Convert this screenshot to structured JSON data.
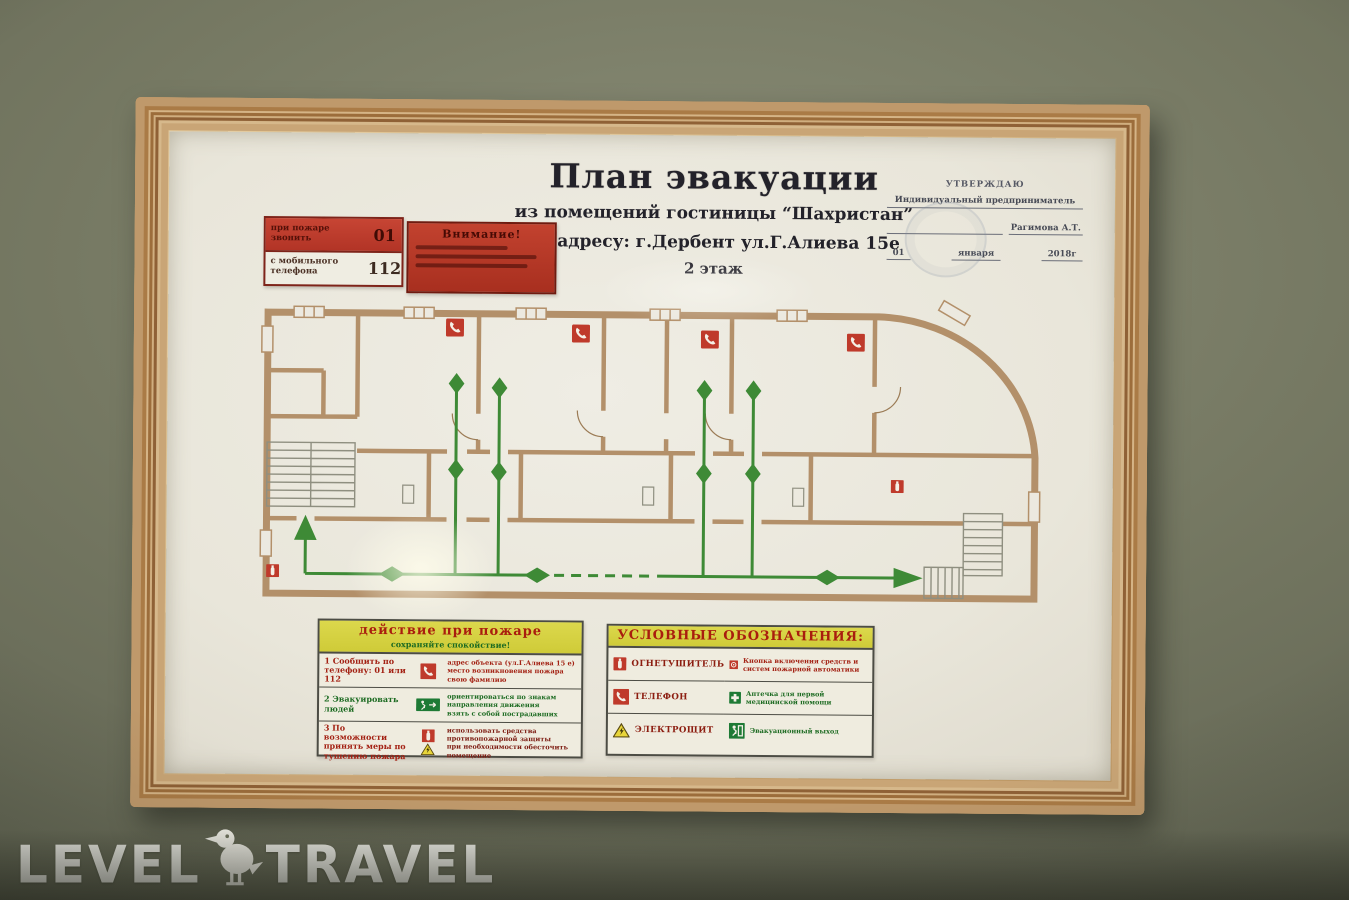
{
  "header": {
    "title": "План эвакуации",
    "subtitle": "из помещений гостиницы “Шахристан”",
    "address": "по адресу: г.Дербент ул.Г.Алиева 15е",
    "floor": "2 этаж"
  },
  "call_box": {
    "top_label": "при пожаре звонить",
    "top_number": "01",
    "bottom_label": "с мобильного телефона",
    "bottom_number": "112"
  },
  "attention_box": {
    "title": "Внимание!"
  },
  "approval": {
    "line1": "УТВЕРЖДАЮ",
    "line2": "Индивидуальный предприниматель",
    "name": "Рагимова А.Т.",
    "date_day": "01",
    "date_month": "января",
    "date_year": "2018г"
  },
  "actions_table": {
    "header": "действие при пожаре",
    "subheader": "сохраняйте спокойствие!",
    "rows": [
      {
        "label": "1 Сообщить по телефону: 01 или 112",
        "icon": "phone-icon",
        "desc": [
          "адрес объекта (ул.Г.Алиева 15 е)",
          "место возникновения пожара",
          "свою фамилию"
        ]
      },
      {
        "label": "2 Эвакуировать людей",
        "icon": "emergency-exit-icon",
        "desc": [
          "ориентироваться по знакам",
          "направления движения",
          "взять с собой пострадавших"
        ]
      },
      {
        "label": "3 По возможности принять меры по тушению пожара",
        "icon": "fire-extinguisher-icon warning-triangle-icon",
        "desc": [
          "использовать средства",
          "противопожарной защиты",
          "при необходимости обесточить помещение"
        ]
      }
    ]
  },
  "legend_table": {
    "header": "УСЛОВНЫЕ ОБОЗНАЧЕНИЯ:",
    "items": [
      {
        "icon": "fire-extinguisher-icon",
        "label": "ОГНЕТУШИТЕЛЬ"
      },
      {
        "icon": "fire-alarm-button-icon",
        "label": "Кнопка включения средств и систем пожарной автоматики"
      },
      {
        "icon": "phone-icon",
        "label": "ТЕЛЕФОН"
      },
      {
        "icon": "first-aid-icon",
        "label": "Аптечка для первой медицинской помощи"
      },
      {
        "icon": "electrical-panel-icon",
        "label": "ЭЛЕКТРОЩИТ"
      },
      {
        "icon": "emergency-exit-icon",
        "label": "Эвакуационный выход"
      }
    ]
  },
  "plan": {
    "floor_shown": "2 этаж",
    "phone_icons_count": 4,
    "extinguisher_icons_count": 2,
    "route_color": "#3e8a36",
    "wall_color": "#b3906a"
  },
  "watermark": {
    "word_left": "LEVEL",
    "word_right": "TRAVEL",
    "icon": "bird-icon"
  },
  "colors": {
    "accent_red": "#b02a1c",
    "accent_green": "#3e8a36",
    "legend_yellow": "#d8d441",
    "frame_wood": "#d0ae7f",
    "wall_background": "#6e7260"
  }
}
